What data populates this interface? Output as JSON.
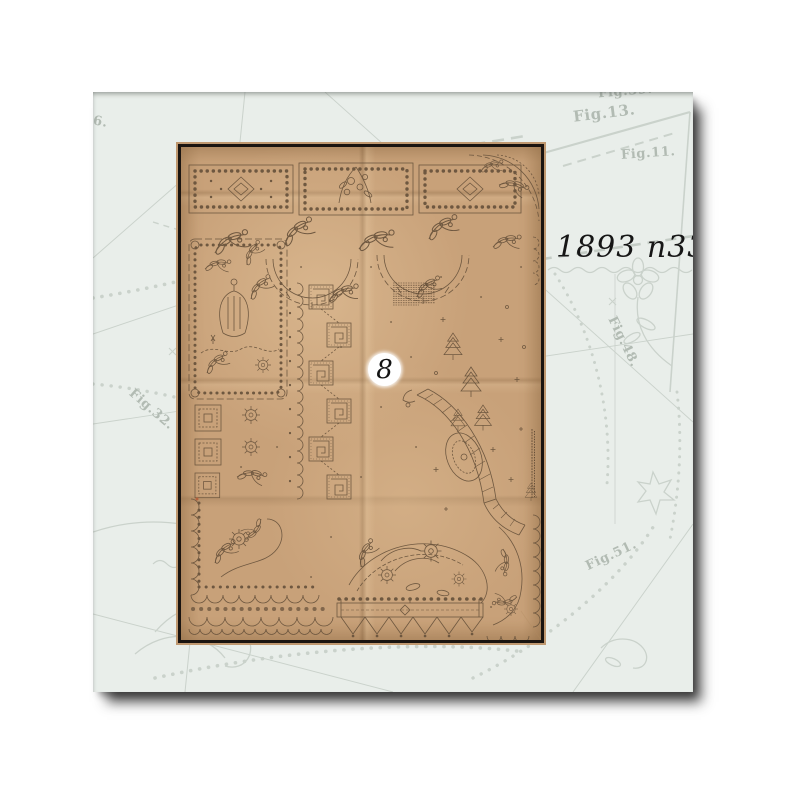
{
  "page": {
    "background_color": "#ffffff"
  },
  "card": {
    "background_color": "#e9eeea",
    "pattern_line_color": "#c7cfc8",
    "fig_labels": [
      {
        "text": "Fig.39."
      },
      {
        "text": "Fig.13."
      },
      {
        "text": "Fig.11."
      },
      {
        "text": "Fig.48."
      },
      {
        "text": "Fig.32."
      },
      {
        "text": "Fig.51."
      },
      {
        "text": "Fig.6."
      }
    ]
  },
  "sheet": {
    "paper_color": "#c8a179",
    "ink_color": "#6a543d",
    "border_color": "#1a1410",
    "number_badge": {
      "value": "8",
      "background": "#ffffff",
      "text_color": "#141414"
    }
  },
  "caption": {
    "text": "1893 n33",
    "color": "#161616"
  }
}
